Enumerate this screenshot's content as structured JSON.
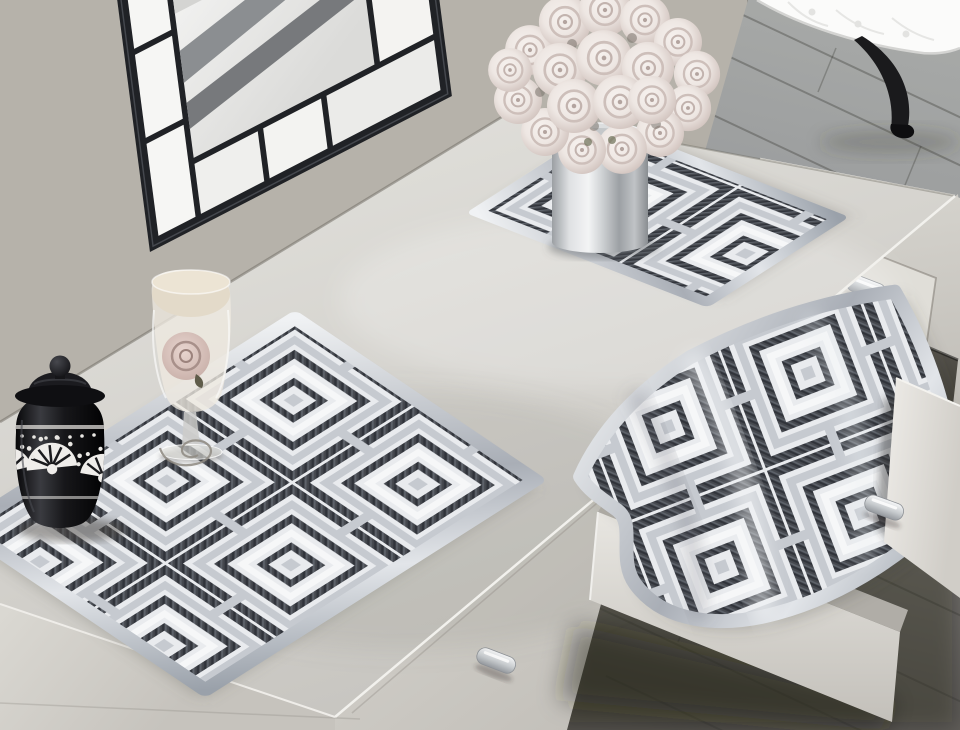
{
  "scene": {
    "setting": "Photograph of a white dressing table against a beige wall on a gray plank wood floor",
    "objects": [
      {
        "name": "wall-mirror",
        "description": "Tilted black window-pane framed mirror with frosted side panels reflecting the tabletop and roses"
      },
      {
        "name": "rose-bouquet",
        "description": "Ball bouquet of cream blush roses"
      },
      {
        "name": "flower-vase",
        "description": "Cylindrical polished silver vase standing on a placemat"
      },
      {
        "name": "placemat-top",
        "description": "Silver and charcoal geometric art-deco placemat behind the vase"
      },
      {
        "name": "placemat-left",
        "description": "Large silver and charcoal geometric placemat with satin border on the tabletop"
      },
      {
        "name": "placemat-draped",
        "description": "Matching placemat draped in a wave over the open drawer"
      },
      {
        "name": "wine-glass",
        "description": "Stemmed glass with a blush rose inside and a wire spiral at its foot"
      },
      {
        "name": "black-jar",
        "description": "Black ceramic lidded jar decorated with white fan palmette motifs"
      },
      {
        "name": "vanity-table",
        "description": "White vanity with drawers and silver bar handles, one drawer pulled open"
      },
      {
        "name": "open-drawer",
        "description": "White drawer box pulled out toward the floor with placemat folded over it"
      },
      {
        "name": "stool",
        "description": "White tufted stool with black cabriole leg on the wood floor"
      },
      {
        "name": "wood-floor",
        "description": "Diagonal gray wood planks, darker in the foreground shadow"
      }
    ],
    "placemat_set_count": 3,
    "drawer_handle_count": 3
  },
  "palette": {
    "wall": "#b3afa7",
    "floor-light": "#a8aaa8",
    "floor-mid": "#83807b",
    "floor-dark": "#57544e",
    "table-top": "#e0dfda",
    "table-mid": "#d3d1cc",
    "table-face": "#d9d7d1",
    "table-face-dark": "#bbb8b2",
    "mat-base": "#e9ebee",
    "mat-silver": "#c6cad0",
    "mat-dark": "#45484e",
    "mat-white": "#f6f7f8",
    "satin-hi": "#f0f2f4",
    "satin-lo": "#a9aeb6",
    "mirror-frame": "#202226",
    "bench-white": "#fbfbfa",
    "leg-black": "#1a1a1c",
    "jar-black": "#0d0d10",
    "rose-cream": "#f6f1ee",
    "rose-shade": "#d5c8c3",
    "metal-hi": "#f6f7f8",
    "metal-lo": "#94989d"
  }
}
